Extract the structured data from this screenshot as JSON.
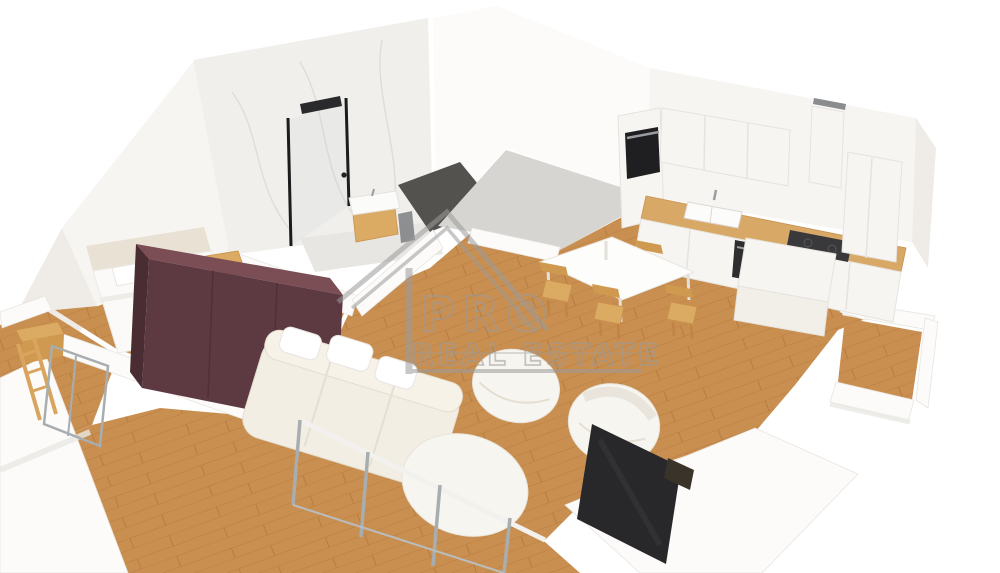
{
  "image": {
    "type": "3d-floor-plan-render",
    "view": "isometric-cutaway-apartment",
    "background": "#ffffff"
  },
  "watermark": {
    "logo": "house-roof-icon",
    "line1": "PRO",
    "line2": "REAL ESTATE"
  },
  "colors": {
    "background": "#ffffff",
    "wood_floor": "#c98f50",
    "wood_plank_line": "#b77c3e",
    "wood_furniture": "#dcab63",
    "wood_furniture_dark": "#cf9a50",
    "wall_white": "#f7f5f2",
    "wall_bright": "#fcfbf9",
    "wall_shade": "#efece8",
    "marble_wall": "#f1efec",
    "hall_floor": "#d7d5d2",
    "doorway_floor_dark": "#54524e",
    "bathroom_floor": "#e8e6e2",
    "wardrobe_front": "#5d3a42",
    "wardrobe_top": "#7b4e55",
    "wardrobe_side": "#4a2d33",
    "headboard_cream": "#e9e2d4",
    "sofa_cream": "#f2eee3",
    "upholstery_white": "#f7f5ef",
    "countertop_wood": "#d8a866",
    "appliance_black": "#1f1f22",
    "cooktop_dark": "#39393c",
    "tv_dark": "#28282b",
    "metal_frame": "#a8adb0",
    "watermark_gray": "#9b9b9b"
  },
  "rooms": [
    {
      "name": "bathroom",
      "items": [
        "marble-wall",
        "walk-in-shower",
        "black-shower-head",
        "glass-panel",
        "vanity-with-sink",
        "wall-mirror"
      ]
    },
    {
      "name": "bedroom",
      "items": [
        "double-bed",
        "pillows",
        "headboard",
        "nightstand",
        "wooden-bench",
        "burgundy-wardrobe"
      ]
    },
    {
      "name": "hallway",
      "items": [
        "gray-floor"
      ]
    },
    {
      "name": "kitchen",
      "items": [
        "oven-column",
        "upper-cabinets",
        "range-hood",
        "sink-with-faucet",
        "induction-cooktop",
        "wood-countertop",
        "base-cabinets",
        "kitchen-island",
        "tall-cabinet"
      ]
    },
    {
      "name": "dining-area",
      "items": [
        "white-dining-table",
        "wooden-chair",
        "wooden-chair",
        "wooden-chair",
        "wooden-chair"
      ]
    },
    {
      "name": "living-room",
      "items": [
        "cream-tufted-sofa",
        "white-pouf-chair",
        "white-armchair",
        "oval-ottoman",
        "flat-tv",
        "glass-balcony-wall"
      ]
    },
    {
      "name": "balcony-left",
      "items": [
        "wood-decking",
        "glass-door",
        "wooden-ladder-shelf",
        "white-parapet"
      ]
    },
    {
      "name": "balcony-right",
      "items": [
        "wood-decking",
        "white-parapet"
      ]
    }
  ]
}
